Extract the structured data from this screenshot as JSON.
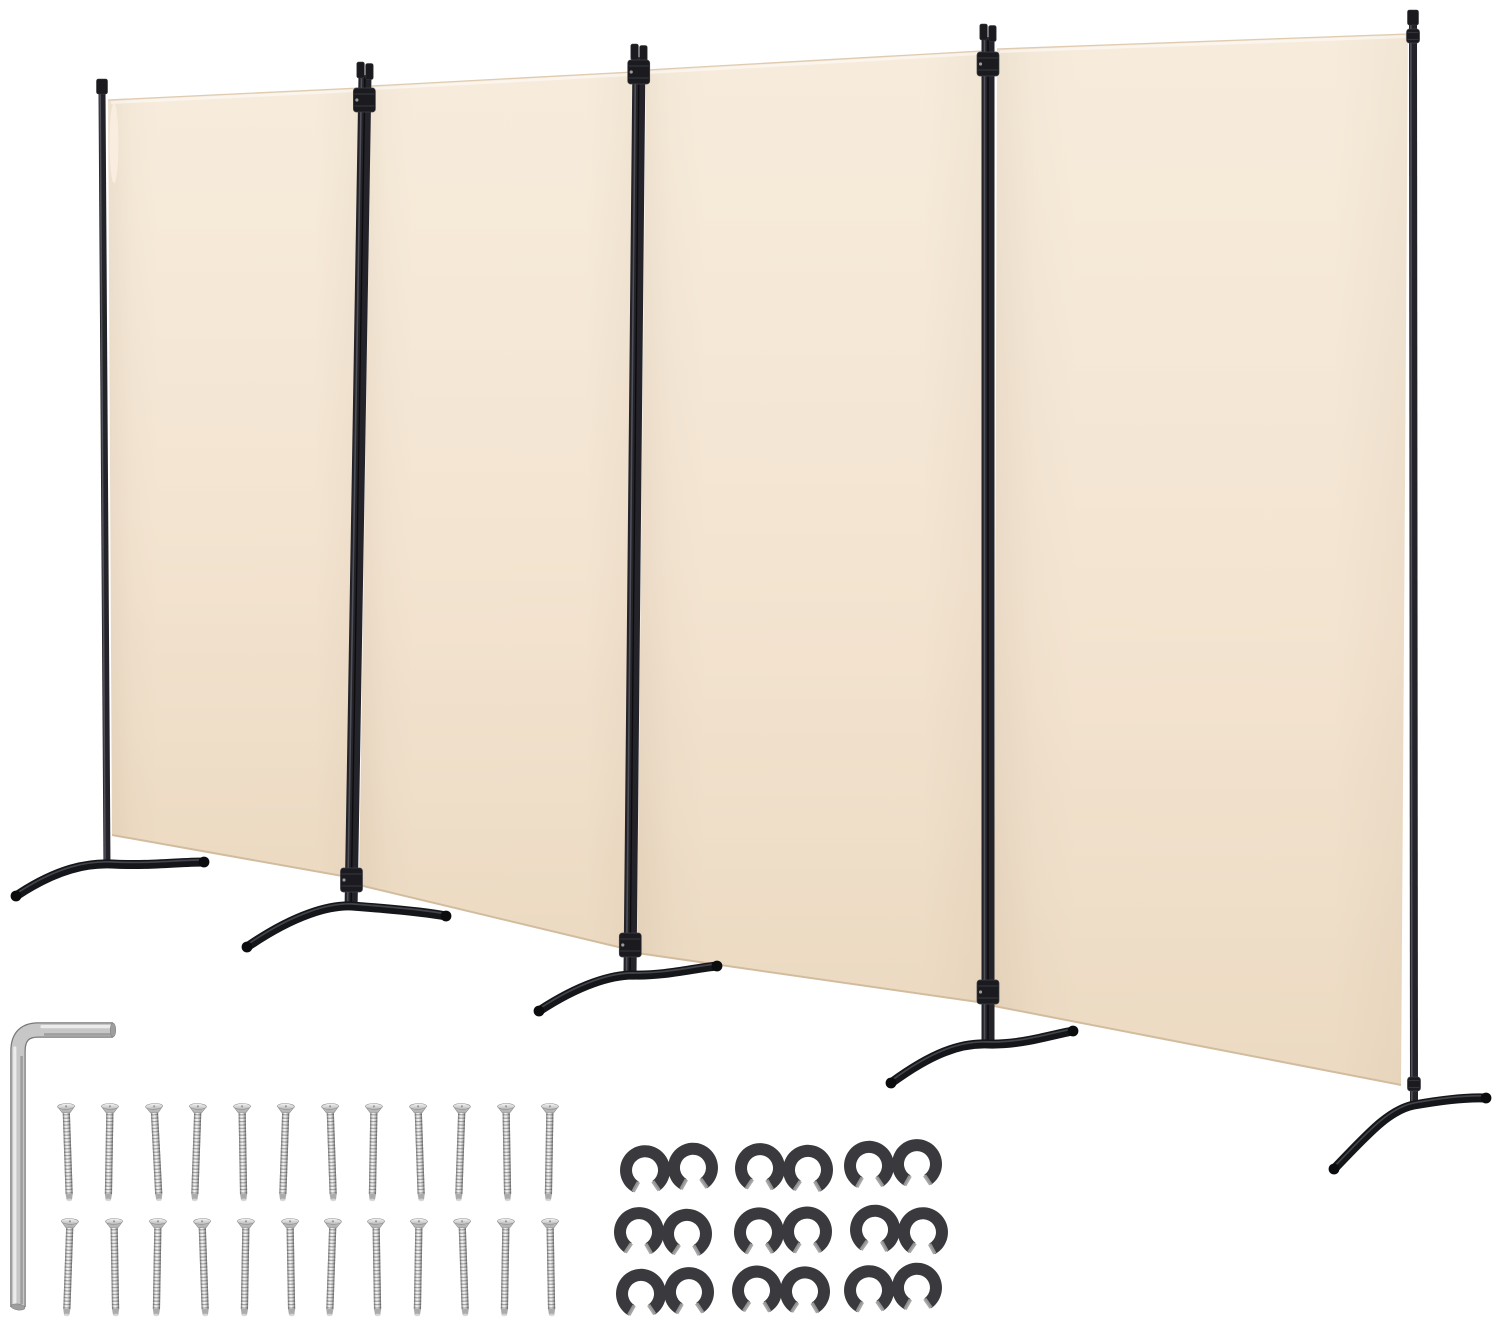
{
  "meta": {
    "description": "Product photo: 4-panel folding room divider privacy screen with beige fabric panels, black metal poles and curved feet, shown with assembly hardware: one L-shaped hex key, 24 silver screws in two rows, and 9 black double-C connector clips in a 3x3 grid",
    "background": "#ffffff"
  },
  "colors": {
    "fabric_top": "#f7ecdc",
    "fabric_mid": "#f3e4d1",
    "fabric_bottom": "#ecdac2",
    "fabric_edge_top": "#dfcbb0",
    "fabric_edge_bottom": "#d3bc9e",
    "frame": "#232329",
    "frame_highlight": "#54555e",
    "frame_seam": "#0c0c0f",
    "cap_fill": "#1b1b1f",
    "cap_stroke": "#3a3b41",
    "foot": "#15161a",
    "foot_highlight": "#4a4c53",
    "foot_tip": "#0b0c0e",
    "hinge_fill": "#1a1a1f",
    "hinge_stroke": "#40414a",
    "steel_main": "#c7c7c7",
    "steel_outline": "#787878",
    "steel_highlight": "#eeeeee",
    "steel_shadow": "#969696",
    "clip": "#3a3a3e",
    "clip_tip": "#9d9d9d"
  },
  "counts": {
    "panels": 4,
    "poles": 5,
    "feet": 5,
    "screws": 24,
    "connector_clips": 9,
    "hex_keys": 1
  },
  "panels": [
    {
      "name": "panel-1",
      "pts": [
        [
          108,
          100
        ],
        [
          360,
          88
        ],
        [
          348,
          877
        ],
        [
          112,
          835
        ]
      ]
    },
    {
      "name": "panel-2",
      "pts": [
        [
          371,
          86
        ],
        [
          633,
          72
        ],
        [
          635,
          951
        ],
        [
          359,
          885
        ]
      ]
    },
    {
      "name": "panel-3",
      "pts": [
        [
          646,
          70
        ],
        [
          982,
          51
        ],
        [
          985,
          1003
        ],
        [
          637,
          953
        ]
      ]
    },
    {
      "name": "panel-4",
      "pts": [
        [
          997,
          49
        ],
        [
          1408,
          34
        ],
        [
          1401,
          1085
        ],
        [
          994,
          1006
        ]
      ]
    }
  ],
  "poles": [
    {
      "name": "pole-1",
      "x1": 102,
      "y1": 79,
      "x2": 107,
      "y2": 868,
      "w": 7,
      "double": false,
      "hinges": []
    },
    {
      "name": "pole-2",
      "x1": 365,
      "y1": 62,
      "x2": 351,
      "y2": 910,
      "w": 13,
      "double": true,
      "hinges": [
        100,
        880
      ]
    },
    {
      "name": "pole-3",
      "x1": 639,
      "y1": 44,
      "x2": 630,
      "y2": 974,
      "w": 13,
      "double": true,
      "hinges": [
        72,
        945
      ]
    },
    {
      "name": "pole-4",
      "x1": 988,
      "y1": 24,
      "x2": 988,
      "y2": 1042,
      "w": 13,
      "double": true,
      "hinges": [
        64,
        992
      ]
    },
    {
      "name": "pole-5",
      "x1": 1413,
      "y1": 10,
      "x2": 1414,
      "y2": 1102,
      "w": 8,
      "double": false,
      "hinges": [
        36,
        1084
      ]
    }
  ],
  "feet": [
    {
      "name": "foot-1",
      "d": "M16,896 C58,868 88,863 112,864 C150,866 178,862 204,862",
      "ends": [
        [
          16,
          896
        ],
        [
          204,
          862
        ]
      ]
    },
    {
      "name": "foot-2",
      "d": "M247,947 C295,914 330,905 352,906 C392,909 425,912 446,916",
      "ends": [
        [
          247,
          947
        ],
        [
          446,
          916
        ]
      ]
    },
    {
      "name": "foot-3",
      "d": "M539,1011 C580,984 612,975 633,975 C665,976 695,968 717,966",
      "ends": [
        [
          539,
          1011
        ],
        [
          717,
          966
        ]
      ]
    },
    {
      "name": "foot-4",
      "d": "M891,1083 C932,1053 960,1043 988,1044 C1022,1045 1050,1035 1073,1031",
      "ends": [
        [
          891,
          1083
        ],
        [
          1073,
          1031
        ]
      ]
    },
    {
      "name": "foot-5",
      "d": "M1334,1169 C1366,1136 1388,1110 1414,1105 C1442,1100 1466,1097 1486,1098",
      "ends": [
        [
          1334,
          1169
        ],
        [
          1486,
          1098
        ]
      ]
    }
  ],
  "wrench": {
    "path": "M113,1030 L38,1030 Q18,1030 18,1051 L18,1307",
    "width": 13,
    "hi_h": "M112,1026.6 L42,1026.6",
    "hi_v": "M14.8,1048 L14.8,1304",
    "sh_h": "M112,1034.4 L44,1034.4",
    "sh_v": "M21.6,1056 L21.6,1304",
    "tips": [
      [
        113,
        1030,
        2.8,
        7.0,
        0
      ],
      [
        18,
        1307,
        7.0,
        3.0,
        8
      ]
    ]
  },
  "screws": {
    "length": 97,
    "head_w": 17,
    "shank_w": 7.2,
    "rows": [
      {
        "y": 1104,
        "xs": [
          66,
          110,
          154,
          198,
          242,
          286,
          330,
          374,
          418,
          462,
          506,
          550
        ],
        "tilts": [
          -2,
          1,
          -3,
          2,
          -1,
          2,
          -2,
          1,
          -2,
          2,
          -1,
          1
        ]
      },
      {
        "y": 1219,
        "xs": [
          70,
          114,
          158,
          202,
          246,
          290,
          333,
          376,
          419,
          462,
          506,
          550
        ],
        "tilts": [
          2,
          -1,
          1,
          -2,
          1,
          -1,
          2,
          -1,
          1,
          -2,
          1,
          -1
        ]
      }
    ]
  },
  "clips": {
    "cols": [
      669,
      781,
      895
    ],
    "rows": [
      1169,
      1231,
      1291
    ],
    "outer_r": 25,
    "inner_r": 13,
    "gap_deg": 64,
    "spread": 24,
    "tilts": [
      -3,
      2,
      -2,
      2,
      -1,
      3,
      -2,
      1,
      -3
    ],
    "offsets": [
      [
        0,
        0
      ],
      [
        3,
        0
      ],
      [
        -2,
        -4
      ],
      [
        -6,
        2
      ],
      [
        2,
        1
      ],
      [
        4,
        0
      ],
      [
        -4,
        2
      ],
      [
        0,
        0
      ],
      [
        -2,
        -2
      ]
    ]
  }
}
